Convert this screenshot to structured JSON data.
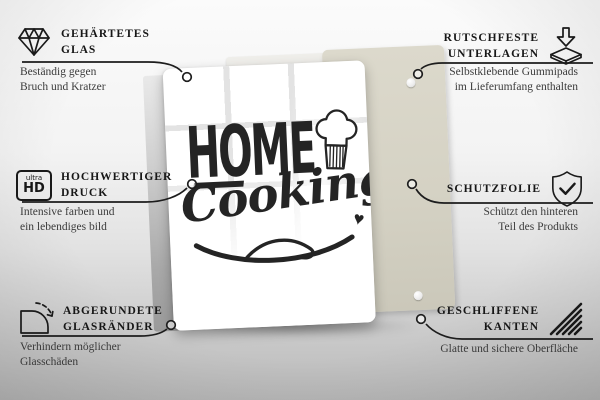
{
  "product": {
    "design": {
      "word1": "HOME",
      "word2": "Cooking",
      "heart": "♥"
    }
  },
  "annotations": {
    "top_left": {
      "icon": "diamond-icon",
      "title1": "GEHÄRTETES",
      "title2": "GLAS",
      "desc1": "Beständig gegen",
      "desc2": "Bruch und Kratzer"
    },
    "top_right": {
      "icon": "rubber-pad-icon",
      "title1": "RUTSCHFESTE",
      "title2": "UNTERLAGEN",
      "desc1": "Selbstklebende Gummipads",
      "desc2": "im Lieferumfang enthalten"
    },
    "mid_left": {
      "icon": "ultra-hd-icon",
      "icon_small": "ultra",
      "icon_big": "HD",
      "title1": "HOCHWERTIGER",
      "title2": "DRUCK",
      "desc1": "Intensive farben und",
      "desc2": "ein lebendiges bild"
    },
    "mid_right": {
      "icon": "shield-check-icon",
      "title1": "SCHUTZFOLIE",
      "desc1": "Schützt den hinteren",
      "desc2": "Teil des Produkts"
    },
    "bottom_left": {
      "icon": "rounded-corner-icon",
      "title1": "ABGERUNDETE",
      "title2": "GLASRÄNDER",
      "desc1": "Verhindern möglicher",
      "desc2": "Glasschäden"
    },
    "bottom_right": {
      "icon": "hatched-edges-icon",
      "title1": "GESCHLIFFENE",
      "title2": "KANTEN",
      "desc1": "Glatte und sichere Oberfläche"
    }
  },
  "colors": {
    "leader_line": "#1d1d1d",
    "title_text": "#171717",
    "desc_text": "#3c3c3c",
    "design_ink": "#242424",
    "glass": "#ffffff",
    "back_panel": "#d5d2c4",
    "background_top": "#fbfbfb",
    "background_bottom": "#b6b6b6"
  }
}
